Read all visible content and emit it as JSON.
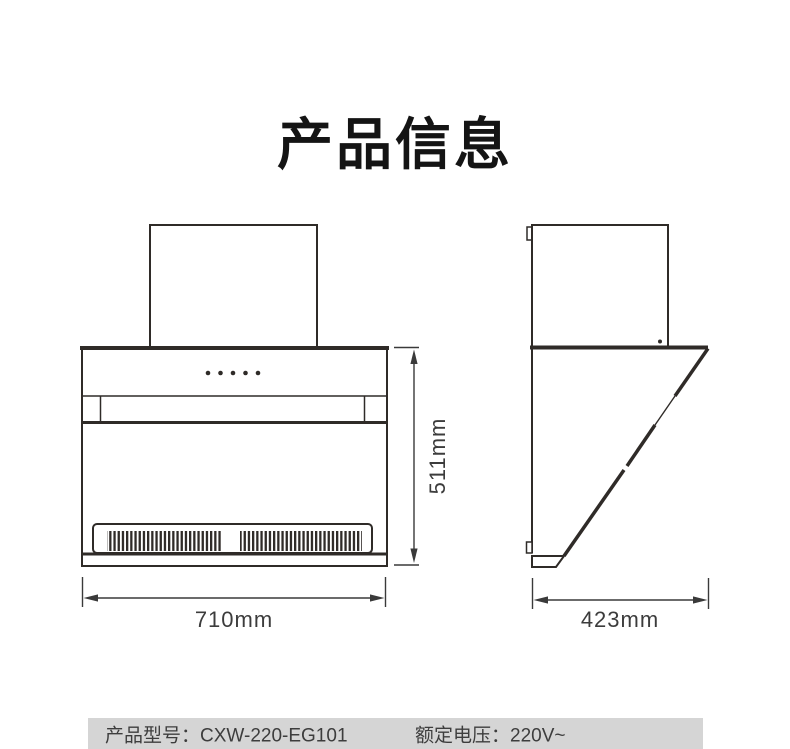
{
  "page": {
    "title": "产品信息",
    "background": "#ffffff"
  },
  "drawings": {
    "line_color": "#2f2b28",
    "front_view": {
      "width_label": "710mm",
      "height_label": "511mm"
    },
    "side_view": {
      "depth_label": "423mm"
    }
  },
  "footer": {
    "background": "#d5d5d5",
    "model": {
      "label": "产品型号：",
      "value": "CXW-220-EG101"
    },
    "voltage": {
      "label": "额定电压：",
      "value": "220V~"
    }
  }
}
